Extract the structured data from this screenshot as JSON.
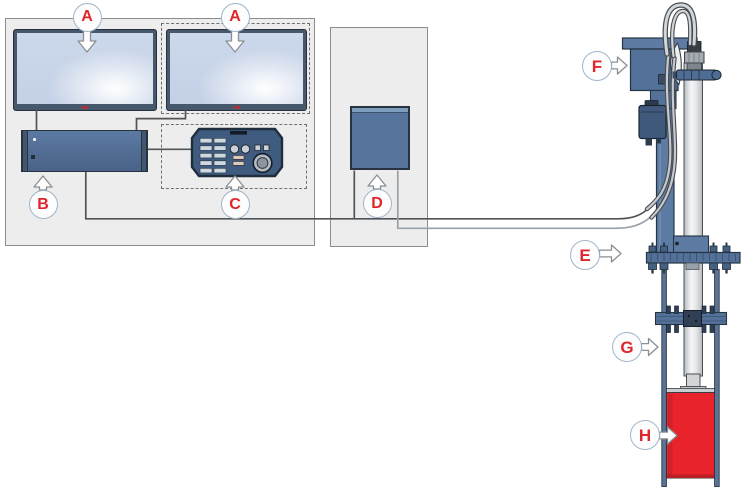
{
  "callouts": {
    "a1": {
      "letter": "A"
    },
    "a2": {
      "letter": "A"
    },
    "b": {
      "letter": "B"
    },
    "c": {
      "letter": "C"
    },
    "d": {
      "letter": "D"
    },
    "e": {
      "letter": "E"
    },
    "f": {
      "letter": "F"
    },
    "g": {
      "letter": "G"
    },
    "h": {
      "letter": "H"
    }
  },
  "colors": {
    "callout_letter_red": "#de262c",
    "equipment_blue": "#54719a",
    "equipment_blue_light": "#5e7ca3",
    "panel_gray": "#ededed",
    "screen_blue": "#c7d4e8",
    "cylinder_red": "#e8232b",
    "cable_dark": "#4f5458",
    "cable_light": "#9aa1a8",
    "mast_gray": "#e9eaec"
  }
}
